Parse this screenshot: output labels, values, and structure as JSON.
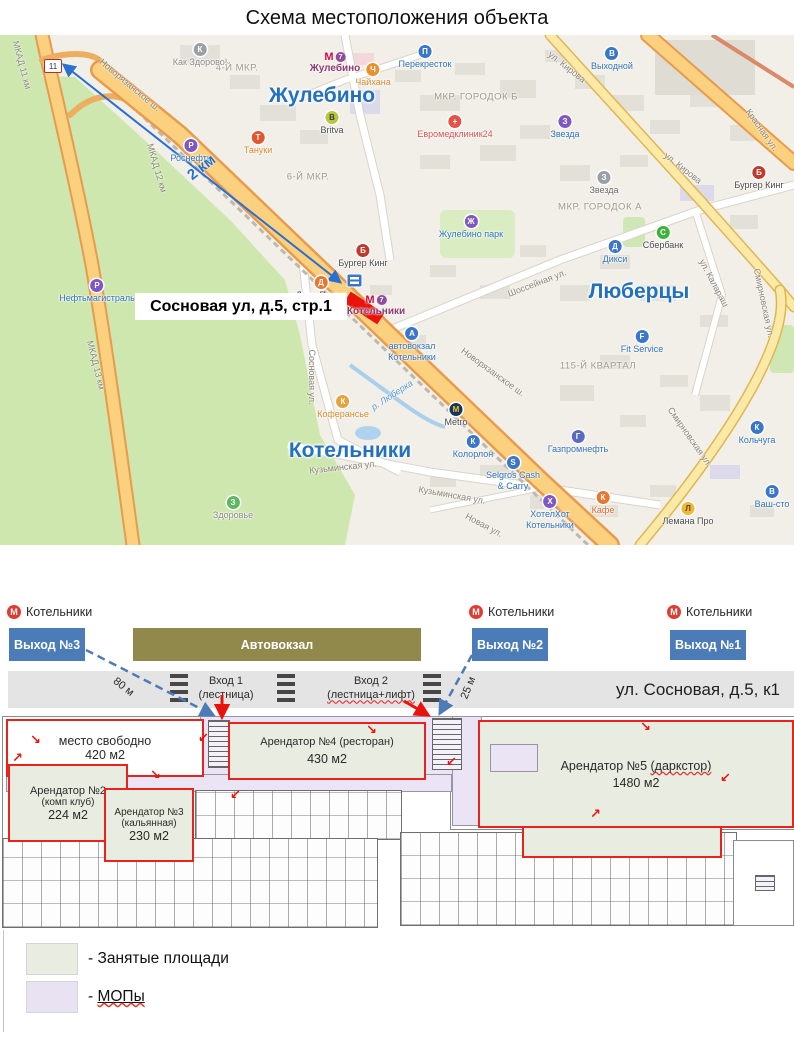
{
  "title": "Схема местоположения объекта",
  "map": {
    "callout": "Сосновая ул, д.5, стр.1",
    "distance_arrow_label": "2 км",
    "road_sign": "11",
    "cities": [
      {
        "label": "Жулебино",
        "x": 322,
        "y": 61
      },
      {
        "label": "Люберцы",
        "x": 639,
        "y": 257
      },
      {
        "label": "Котельники",
        "x": 350,
        "y": 416
      }
    ],
    "districts": [
      {
        "label": "4-Й МКР.",
        "x": 237,
        "y": 33
      },
      {
        "label": "6-Й МКР.",
        "x": 308,
        "y": 142
      },
      {
        "label": "МКР. ГОРОДОК Б",
        "x": 476,
        "y": 62
      },
      {
        "label": "МКР. ГОРОДОК А",
        "x": 600,
        "y": 172
      },
      {
        "label": "115-Й КВАРТАЛ",
        "x": 598,
        "y": 331
      }
    ],
    "metro_stations": [
      {
        "label": "Жулебино",
        "x": 335,
        "y": 16,
        "line": "7"
      },
      {
        "label": "Котельники",
        "x": 376,
        "y": 259,
        "line": "7"
      }
    ],
    "roads": [
      {
        "label": "Новорязанское ш.",
        "x": 130,
        "y": 50,
        "rotate": 40
      },
      {
        "label": "Новорязанское ш.",
        "x": 493,
        "y": 337,
        "rotate": 36
      },
      {
        "label": "МКАД 11 км",
        "x": 22,
        "y": 30,
        "rotate": 75
      },
      {
        "label": "МКАД 12 км",
        "x": 157,
        "y": 133,
        "rotate": 74
      },
      {
        "label": "МКАД 13 км",
        "x": 96,
        "y": 330,
        "rotate": 76
      },
      {
        "label": "ул. Кирова",
        "x": 567,
        "y": 32,
        "rotate": 38
      },
      {
        "label": "ул. Кирова",
        "x": 683,
        "y": 133,
        "rotate": 38
      },
      {
        "label": "Красная ул.",
        "x": 762,
        "y": 95,
        "rotate": 55
      },
      {
        "label": "Шоссейная ул.",
        "x": 537,
        "y": 248,
        "rotate": -21
      },
      {
        "label": "ул. Калараш",
        "x": 714,
        "y": 248,
        "rotate": 62
      },
      {
        "label": "Смирновская ул.",
        "x": 764,
        "y": 268,
        "rotate": 78
      },
      {
        "label": "Смирновская ул.",
        "x": 690,
        "y": 402,
        "rotate": 55
      },
      {
        "label": "Кузьминская ул.",
        "x": 343,
        "y": 432,
        "rotate": -6
      },
      {
        "label": "Кузьминская ул.",
        "x": 452,
        "y": 460,
        "rotate": 10
      },
      {
        "label": "Сосновая ул.",
        "x": 312,
        "y": 342,
        "rotate": 90
      },
      {
        "label": "Новая ул.",
        "x": 484,
        "y": 490,
        "rotate": 28
      },
      {
        "label": "р. Люберка",
        "x": 392,
        "y": 360,
        "rotate": -33,
        "water": true
      }
    ],
    "pois": [
      {
        "label": "Как Здорово!",
        "x": 200,
        "y": 8,
        "icon": "К",
        "ic": "#9AA0A6",
        "tc": "#8A8A84"
      },
      {
        "label": "Перекресток",
        "x": 425,
        "y": 10,
        "icon": "П",
        "ic": "#3A76C9",
        "tc": "#2F71B8"
      },
      {
        "label": "Выходной",
        "x": 612,
        "y": 12,
        "icon": "В",
        "ic": "#3A76C9",
        "tc": "#2F71B8"
      },
      {
        "label": "Чайхана",
        "x": 373,
        "y": 28,
        "icon": "Ч",
        "ic": "#E8912D",
        "tc": "#D98A2B"
      },
      {
        "label": "Britva",
        "x": 332,
        "y": 76,
        "icon": "B",
        "ic": "#B5C93F",
        "tc": "#4A4A4A",
        "gc": "#3b3b3b"
      },
      {
        "label": "Тануки",
        "x": 258,
        "y": 96,
        "icon": "Т",
        "ic": "#E2572F",
        "tc": "#D98A2B"
      },
      {
        "label": "Роснефть",
        "x": 191,
        "y": 104,
        "icon": "Р",
        "ic": "#7E57C2",
        "tc": "#2F71B8"
      },
      {
        "label": "Евромедклиник24",
        "x": 455,
        "y": 80,
        "icon": "+",
        "ic": "#E25349",
        "tc": "#D9534F"
      },
      {
        "label": "Звезда",
        "x": 565,
        "y": 80,
        "icon": "З",
        "ic": "#7E57C2",
        "tc": "#2F71B8"
      },
      {
        "label": "Звезда",
        "x": 604,
        "y": 136,
        "icon": "З",
        "ic": "#9AA0A6",
        "tc": "#6D6D6D"
      },
      {
        "label": "Бургер Кинг",
        "x": 759,
        "y": 131,
        "icon": "Б",
        "ic": "#C0392B",
        "tc": "#4A4A4A"
      },
      {
        "label": "Сбербанк",
        "x": 663,
        "y": 191,
        "icon": "С",
        "ic": "#3BB33B",
        "tc": "#4A4A4A"
      },
      {
        "label": "Дикси",
        "x": 615,
        "y": 205,
        "icon": "Д",
        "ic": "#3A76C9",
        "tc": "#2F71B8"
      },
      {
        "label": "Жулебино парк",
        "x": 471,
        "y": 180,
        "icon": "Ж",
        "ic": "#7E57C2",
        "tc": "#2F71B8"
      },
      {
        "label": "Бургер Кинг",
        "x": 363,
        "y": 209,
        "icon": "Б",
        "ic": "#C0392B",
        "tc": "#4A4A4A"
      },
      {
        "label": "Додо Пицца",
        "x": 321,
        "y": 241,
        "icon": "Д",
        "ic": "#E8762D",
        "tc": "#4A4A4A"
      },
      {
        "label": "Fit Service",
        "x": 642,
        "y": 295,
        "icon": "F",
        "ic": "#3A76C9",
        "tc": "#2F71B8"
      },
      {
        "lines": [
          "автовокзал",
          "Котельники"
        ],
        "x": 412,
        "y": 292,
        "icon": "А",
        "ic": "#3A76C9",
        "tc": "#2F71B8"
      },
      {
        "label": "Коферансье",
        "x": 343,
        "y": 360,
        "icon": "К",
        "ic": "#E8A23C",
        "tc": "#D98A2B"
      },
      {
        "label": "Metro",
        "x": 456,
        "y": 368,
        "icon": "М",
        "ic": "#16355F",
        "tc": "#4A4A4A",
        "gc": "#F5C518"
      },
      {
        "label": "Колорлон",
        "x": 473,
        "y": 400,
        "icon": "К",
        "ic": "#3A76C9",
        "tc": "#2F71B8"
      },
      {
        "lines": [
          "Selgros Cash",
          "& Carry"
        ],
        "x": 513,
        "y": 421,
        "icon": "S",
        "ic": "#3A76C9",
        "tc": "#2F71B8"
      },
      {
        "lines": [
          "ХотелХот",
          "Котельники"
        ],
        "x": 550,
        "y": 460,
        "icon": "Х",
        "ic": "#7E57C2",
        "tc": "#2F71B8"
      },
      {
        "label": "Газпромнефть",
        "x": 578,
        "y": 395,
        "icon": "Г",
        "ic": "#5C6BC0",
        "tc": "#2F71B8"
      },
      {
        "label": "Кафе",
        "x": 603,
        "y": 456,
        "icon": "К",
        "ic": "#E8762D",
        "tc": "#D96A2B"
      },
      {
        "label": "Лемана Про",
        "x": 688,
        "y": 467,
        "icon": "Л",
        "ic": "#F2B630",
        "tc": "#4A4A4A",
        "gc": "#4a4a4a"
      },
      {
        "label": "Кольчуга",
        "x": 757,
        "y": 386,
        "icon": "К",
        "ic": "#3A76C9",
        "tc": "#2F71B8"
      },
      {
        "label": "Ваш-сто",
        "x": 772,
        "y": 450,
        "icon": "В",
        "ic": "#3A76C9",
        "tc": "#2F71B8"
      },
      {
        "label": "Здоровье",
        "x": 233,
        "y": 461,
        "icon": "З",
        "ic": "#5CB85C",
        "tc": "#8A8A84"
      },
      {
        "label": "Нефтьмагистраль",
        "x": 97,
        "y": 244,
        "icon": "Р",
        "ic": "#7E57C2",
        "tc": "#2F71B8"
      }
    ]
  },
  "plan": {
    "metro_exit_label": "Котельники",
    "exit_boxes": [
      {
        "label": "Выход №3"
      },
      {
        "label": "Выход №2"
      },
      {
        "label": "Выход №1"
      }
    ],
    "bus_station": "Автовокзал",
    "street": "ул. Сосновая, д.5, к1",
    "dist1": "80 м",
    "dist2": "25 м",
    "entrance1_l1": "Вход 1",
    "entrance1_l2": "(лестница)",
    "entrance2_l1": "Вход 2",
    "entrance2_l2": "(лестница+лифт)",
    "areas": [
      {
        "l1": "место свободно",
        "l2": "420 м2"
      },
      {
        "l1": "Арендатор №2",
        "l2": "(комп клуб)",
        "l3": "224 м2"
      },
      {
        "l1": "Арендатор №3",
        "l2": "(кальянная)",
        "l3": "230 м2"
      },
      {
        "l1": "Арендатор №4 (ресторан)",
        "l2": "430 м2"
      },
      {
        "pre": "Арендатор №5 ",
        "mis": "(даркстор)",
        "l2": "1480 м2"
      }
    ]
  },
  "legend": {
    "items": [
      {
        "prefix": "- ",
        "text": "Занятые площади",
        "swatch": "#E9ECE0"
      },
      {
        "prefix": "- ",
        "text": "МОПы",
        "swatch": "#E9E2F3"
      }
    ]
  },
  "colors": {
    "exit_box_blue": "#4C7CB8",
    "bus_station_olive": "#91894C",
    "occupied_fill": "#E9ECE0",
    "mop_fill": "#EAE4F4",
    "outline_red": "#E8221C",
    "arrow_blue": "#2B6FD0",
    "map_green": "#CDE7AE",
    "map_highway_orange": "#F3A93C"
  }
}
